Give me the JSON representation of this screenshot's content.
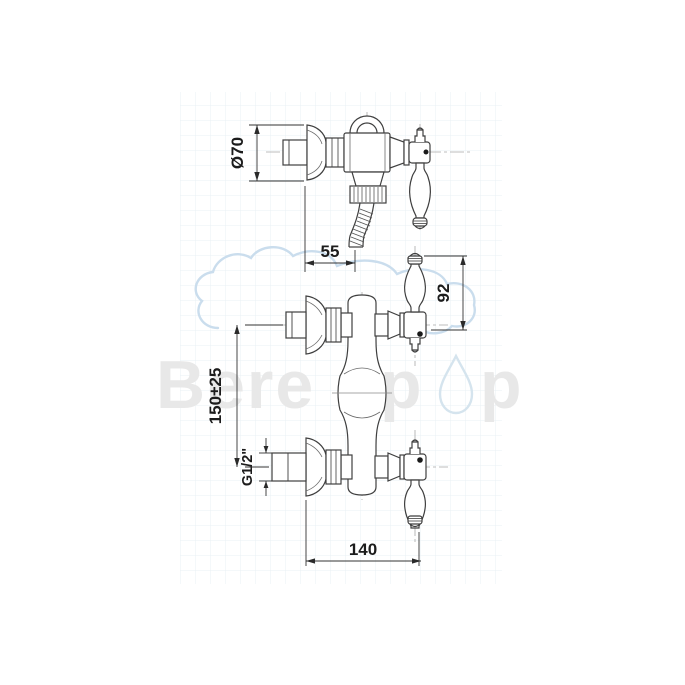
{
  "drawing": {
    "dim_diameter": "Ø70",
    "dim_depth": "55",
    "dim_handle_height": "92",
    "dim_inlet_centers": "150±25",
    "dim_thread": "G1/2\"",
    "dim_overall": "140",
    "units": "mm",
    "line_color": "#3f3f3f",
    "dim_color": "#2a2a2a"
  },
  "watermark": {
    "word_start": "Bere",
    "word_mid": "p",
    "word_end": "p",
    "full_text": "Berepop",
    "letter_color": "#e8e8e8",
    "outline_color": "#cdddea",
    "grid_color": "#eaf0f4"
  }
}
